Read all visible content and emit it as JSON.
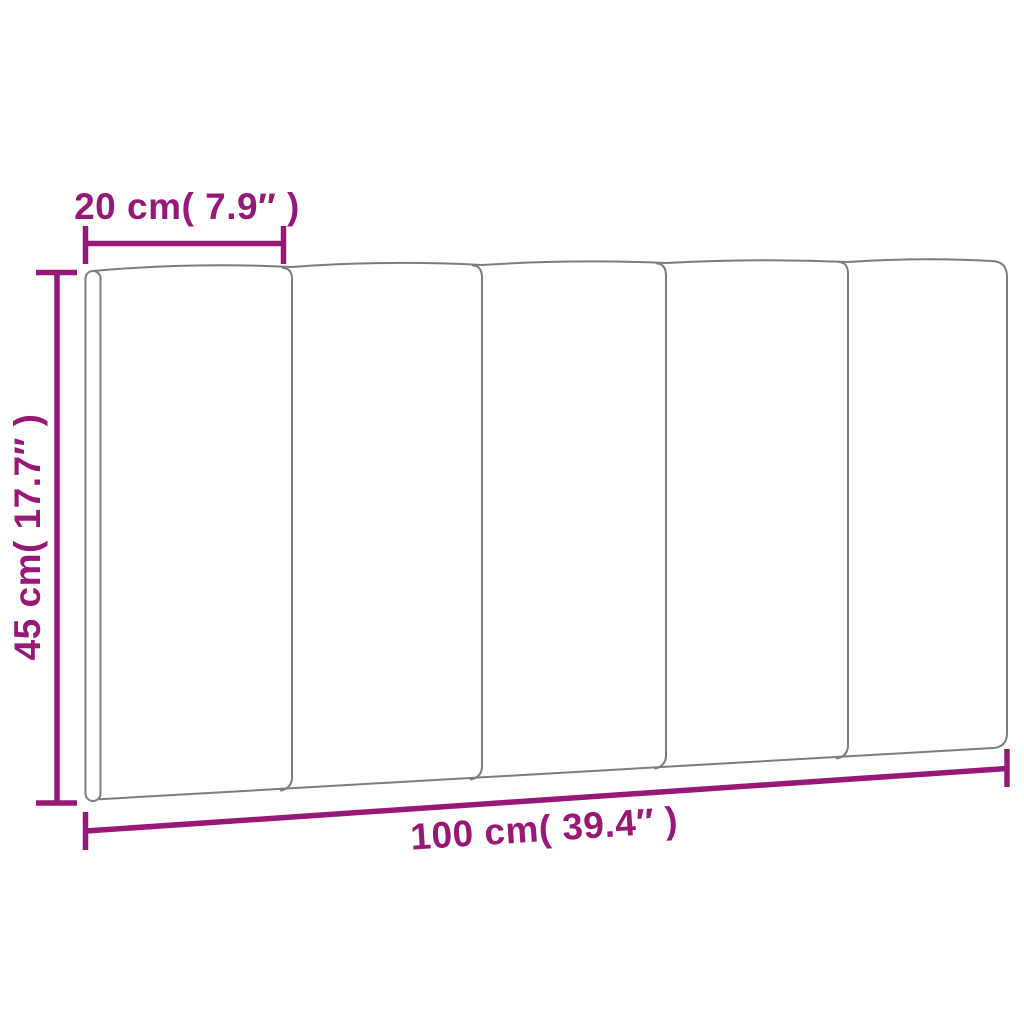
{
  "diagram": {
    "name": "headboard-cushion-dimension-diagram",
    "product": "5-panel headboard cushion",
    "panel_count": 5,
    "labels": {
      "panel_width": "20 cm( 7.9″ )",
      "height": "45 cm( 17.7″ )",
      "total_width": "100 cm( 39.4″ )"
    },
    "measurements": {
      "panel_width_cm": 20,
      "panel_width_in": 7.9,
      "height_cm": 45,
      "height_in": 17.7,
      "total_width_cm": 100,
      "total_width_in": 39.4
    },
    "colors": {
      "dimension": "#981878",
      "outline": "#7d7d7d",
      "background": "#ffffff"
    }
  }
}
